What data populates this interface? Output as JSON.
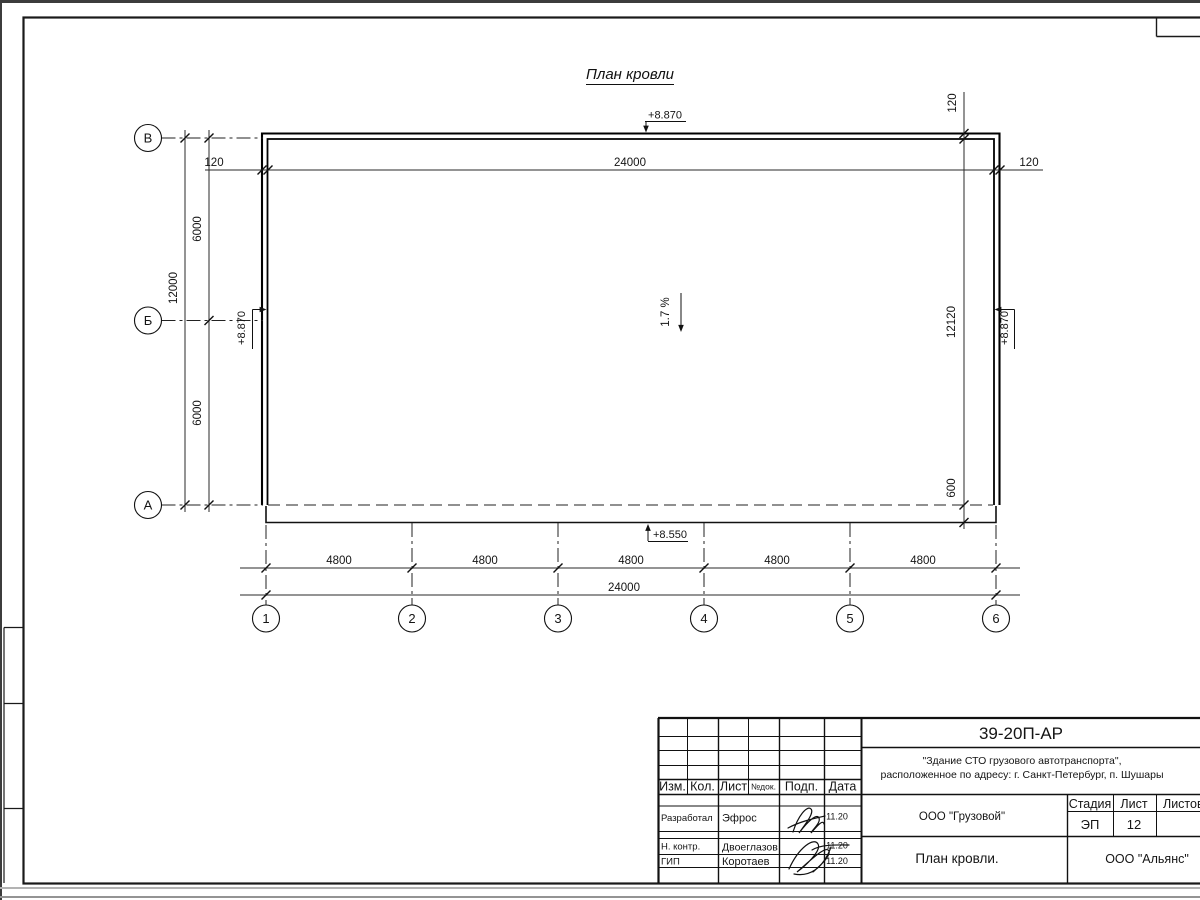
{
  "drawing": {
    "title": "План кровли",
    "slope": "1.7 %",
    "elev": {
      "top": "+8.870",
      "left": "+8.870",
      "right": "+8.870",
      "eaves": "+8.550"
    },
    "dims": {
      "top_total": "24000",
      "top_left": "120",
      "top_right": "120",
      "left_total": "12000",
      "left_seg": [
        "6000",
        "6000"
      ],
      "right_top": "120",
      "right_total": "12120",
      "right_overhang": "600",
      "bottom_seg": [
        "4800",
        "4800",
        "4800",
        "4800",
        "4800"
      ],
      "bottom_total": "24000"
    },
    "grid": {
      "rows": [
        "В",
        "Б",
        "А"
      ],
      "cols": [
        "1",
        "2",
        "3",
        "4",
        "5",
        "6"
      ]
    }
  },
  "titleblock": {
    "doc_number": "39-20П-АР",
    "object_line1": "\"Здание СТО грузового автотранспорта\",",
    "object_line2": "расположенное по адресу: г. Санкт-Петербург, п. Шушары",
    "org_customer": "ООО \"Грузовой\"",
    "sheet_title": "План кровли.",
    "org_designer": "ООО \"Альянс\"",
    "stage_label": "Стадия",
    "sheet_label": "Лист",
    "sheets_label": "Листов",
    "stage_value": "ЭП",
    "sheet_value": "12",
    "columns": {
      "izm": "Изм.",
      "kol": "Кол.",
      "list": "Лист",
      "ndok": "№док.",
      "podp": "Подп.",
      "data": "Дата"
    },
    "rows": [
      {
        "role": "Разработал",
        "name": "Эфрос",
        "date": "11.20"
      },
      {
        "role": "Н. контр.",
        "name": "Двоеглазов",
        "date": "11.20"
      },
      {
        "role": "ГИП",
        "name": "Коротаев",
        "date": "11.20"
      }
    ]
  }
}
